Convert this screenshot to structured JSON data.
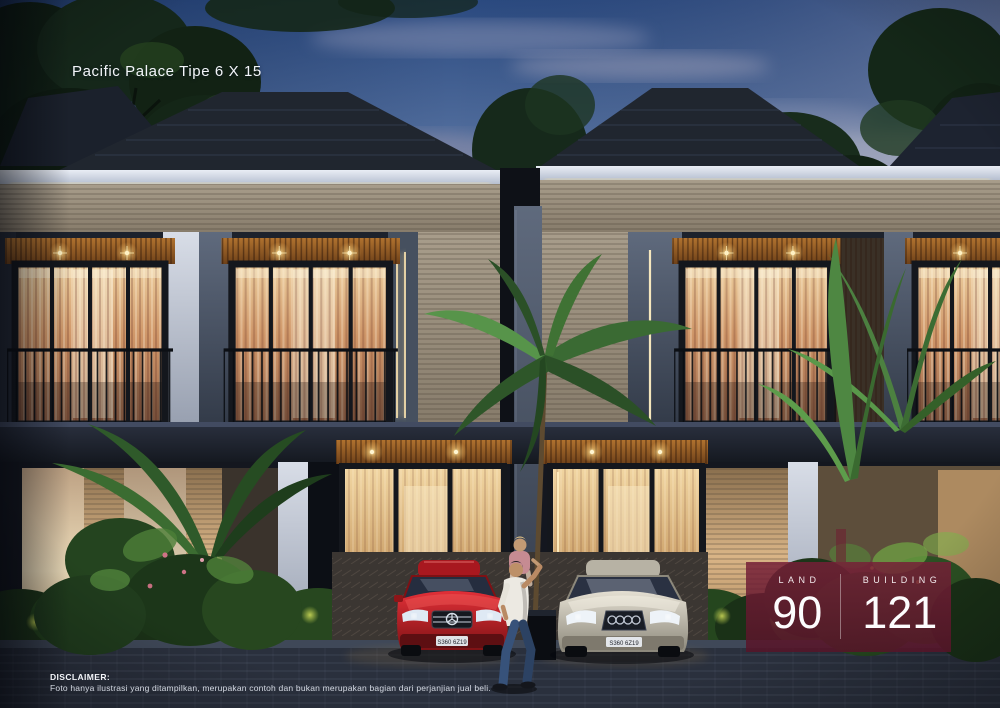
{
  "overlay": {
    "title": "Pacific Palace Tipe 6 X 15",
    "disclaimer": {
      "heading": "DISCLAIMER:",
      "body": "Foto hanya ilustrasi yang ditampilkan, merupakan contoh dan bukan merupakan bagian dari perjanjian jual beli."
    },
    "stats_panel": {
      "panel_color": "#701C32",
      "stats": [
        {
          "label": "LAND",
          "value": "90"
        },
        {
          "label": "BUILDING",
          "value": "121"
        }
      ]
    }
  },
  "scene": {
    "subject": "dusk render of two-storey modern townhouses with lit interiors, palms, two parked sedans and a man carrying a child on his shoulders",
    "palette": {
      "sky_top": "#2B4A80",
      "sky_horizon": "#B3BCD2",
      "warm_light": "#F3DFA0",
      "roof": "#1B212C",
      "stone": "#9A9080",
      "foliage": "#2C5126"
    },
    "cars": [
      {
        "color": "red",
        "plate": "S360 6Z19"
      },
      {
        "color": "silver",
        "plate": "S360 6Z19"
      }
    ]
  }
}
